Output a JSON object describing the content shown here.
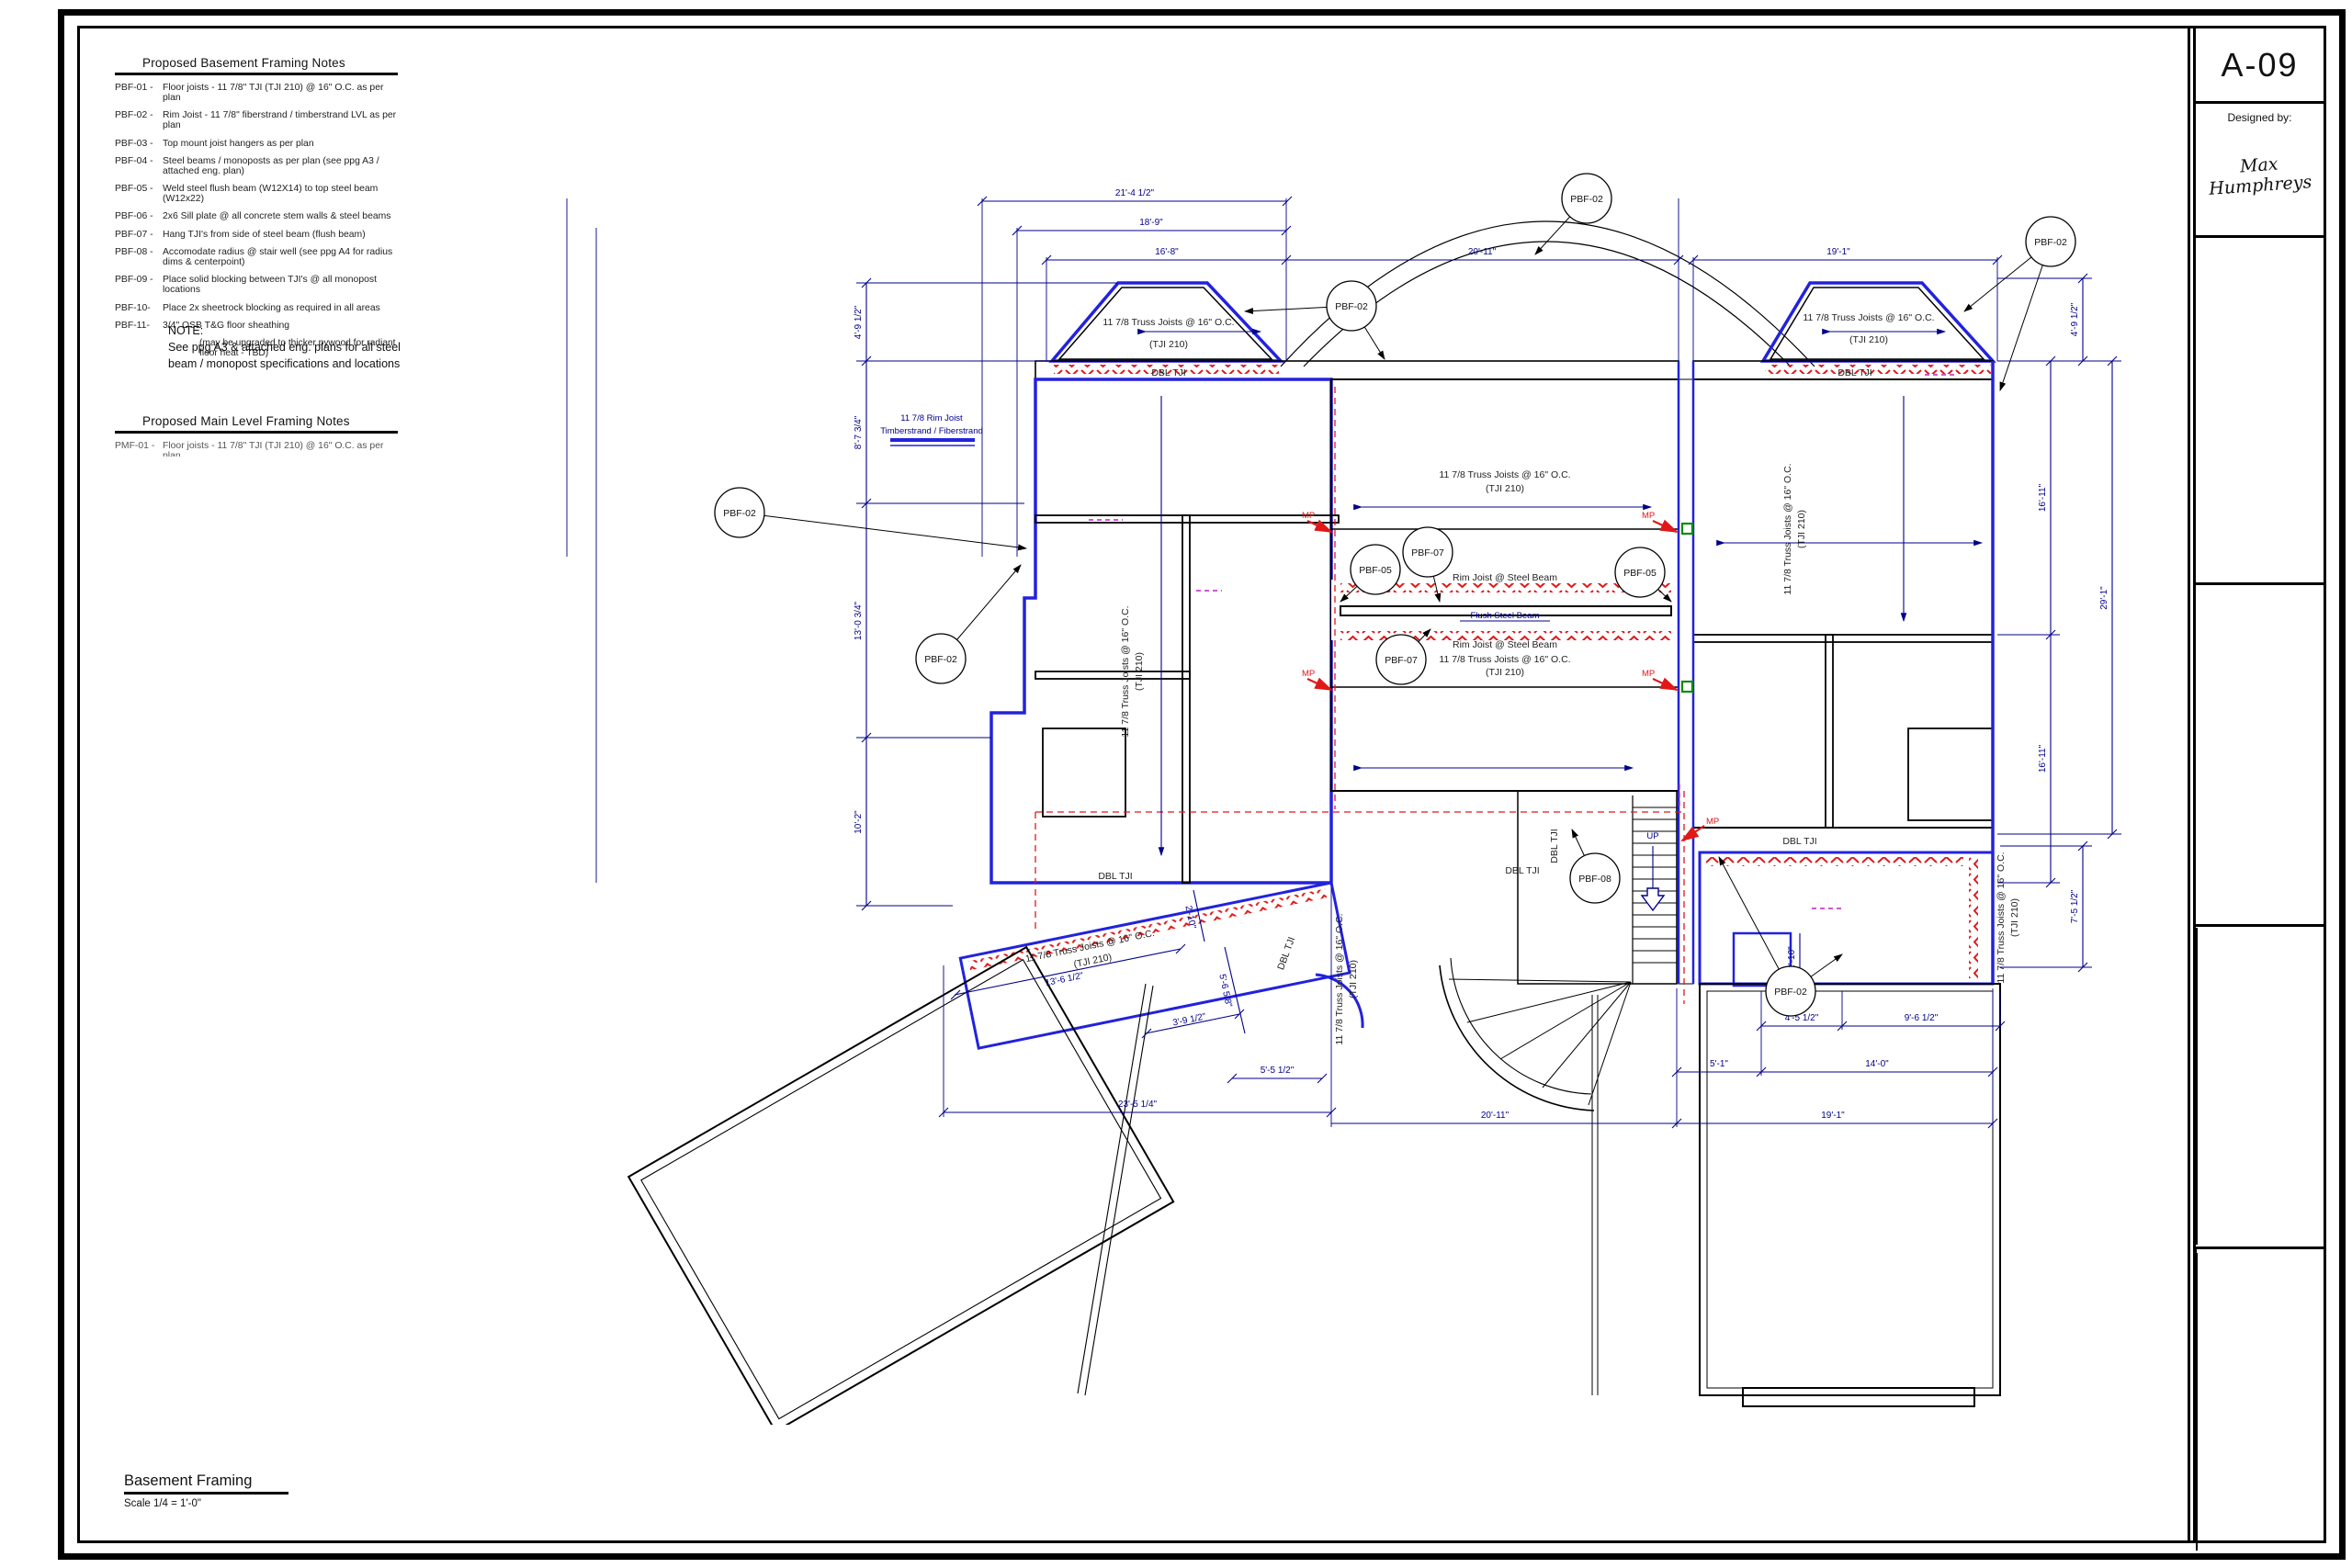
{
  "sheet": {
    "number": "A-09",
    "designed_by_label": "Designed by:",
    "designer": "Max Humphreys"
  },
  "client": {
    "line1": "Custom Architectural Drawing For",
    "name": "Ray & Shirley Quintana",
    "addr1": "2170 S. Wolcott Ct.",
    "addr2": "Denver, CO 80219"
  },
  "company": {
    "name1": "Basement",
    "name2": "DesignWorks",
    "name3": "by C&D, Inc.",
    "addr1": "14 Inverness Drive East",
    "addr2": "Suite G-136",
    "addr3": "Englewood, CO 80112",
    "addr4": "Phone: 303-799-0728",
    "addr5": "Fax: 303-799-0670",
    "addr6": "E-mail: www.cd-mgmt.com"
  },
  "rev_headers": {
    "date": "Date:",
    "revision": "Revision:",
    "description": "Description:"
  },
  "revisions_upper": [
    {
      "m": "7",
      "r": "Draft 7",
      "d": "08/27/05"
    },
    {
      "m": "8",
      "r": "Draft 8",
      "d": "08/30/05"
    },
    {
      "m": "9",
      "r": "Draft 9",
      "d": "09/05/05"
    },
    {
      "m": "F",
      "r": "Final Drawings",
      "d": "09/30/05"
    }
  ],
  "revisions_lower": [
    {
      "m": "1",
      "r": "Draft 1",
      "d": "05/02/05"
    },
    {
      "m": "2",
      "r": "Draft 2",
      "d": "06/02/05"
    },
    {
      "m": "3",
      "r": "Draft 3",
      "d": "06/18/05"
    },
    {
      "m": "4",
      "r": "Draft 4",
      "d": "07/18/05"
    },
    {
      "m": "5",
      "r": "Draft 5",
      "d": "07/21/05"
    },
    {
      "m": "6",
      "r": "Draft 6",
      "d": "08/10/05"
    }
  ],
  "notes": {
    "title": "Proposed Basement Framing Notes",
    "items": [
      {
        "code": "PBF-01 -",
        "text": "Floor joists - 11 7/8\" TJI (TJI 210) @ 16\" O.C. as per plan"
      },
      {
        "code": "PBF-02 -",
        "text": "Rim Joist - 11 7/8\" fiberstrand / timberstrand LVL as per plan"
      },
      {
        "code": "PBF-03 -",
        "text": "Top mount joist hangers as per plan"
      },
      {
        "code": "PBF-04 -",
        "text": "Steel beams / monoposts as per plan (see ppg A3 / attached eng. plan)"
      },
      {
        "code": "PBF-05 -",
        "text": "Weld steel flush beam (W12X14) to top steel beam (W12x22)"
      },
      {
        "code": "PBF-06 -",
        "text": "2x6 Sill plate @ all concrete stem walls & steel beams"
      },
      {
        "code": "PBF-07 -",
        "text": "Hang TJI's from side of steel beam (flush beam)"
      },
      {
        "code": "PBF-08 -",
        "text": "Accomodate radius @ stair well (see ppg A4 for radius dims & centerpoint)"
      },
      {
        "code": "PBF-09 -",
        "text": "Place solid blocking between TJI's @ all monopost locations"
      },
      {
        "code": "PBF-10-",
        "text": "Place 2x sheetrock blocking as required in all areas"
      },
      {
        "code": "PBF-11-",
        "text": "3/4\" OSB T&G floor sheathing"
      }
    ],
    "sub": "(may be upgraded to thicker pywood for radiant floor heat - TBD)"
  },
  "note_block": {
    "title": "NOTE:",
    "line1": "See ppg A3 & attached eng. plans for all steel",
    "line2": "beam / monopost specifications and locations"
  },
  "main_notes": {
    "title": "Proposed Main Level Framing Notes",
    "first_code": "PMF-01 -",
    "first_text": "Floor joists - 11 7/8\" TJI (TJI 210) @ 16\" O.C. as per plan"
  },
  "footer": {
    "title": "Basement Framing",
    "scale": "Scale 1/4 = 1'-0\""
  },
  "plan": {
    "labels": {
      "truss1": "11 7/8 Truss Joists @ 16\" O.C.",
      "truss2": "(TJI 210)",
      "dbl": "DBL TJI",
      "rim_beam": "Rim Joist @ Steel Beam",
      "flush": "Flush Steel Beam",
      "legend1": "11 7/8 Rim Joist",
      "legend2": "Timberstrand / Fiberstrand",
      "up": "UP",
      "mp": "MP"
    },
    "callouts": {
      "c02": "PBF-02",
      "c05": "PBF-05",
      "c07": "PBF-07",
      "c08": "PBF-08"
    },
    "dims": {
      "t1": "21'-4 1/2\"",
      "t2": "18'-9\"",
      "t3": "16'-8\"",
      "t4": "20'-11\"",
      "t5": "19'-1\"",
      "r1": "4'-9 1/2\"",
      "r2": "16'-11\"",
      "r3": "16'-11\"",
      "r4": "29'-1\"",
      "r5": "7'-5 1/2\"",
      "l1": "4'-9 1/2\"",
      "l2": "8'-7 3/4\"",
      "l3": "13'-0 3/4\"",
      "l4": "10'-2\"",
      "b1": "23'-5 1/4\"",
      "b2": "20'-11\"",
      "b3": "19'-1\"",
      "b4": "14'-0\"",
      "b5": "5'-1\"",
      "b6": "4'-5 1/2\"",
      "b7": "9'-6 1/2\"",
      "b8": "5'-5 1/2\"",
      "a1": "2'-10\"",
      "a2": "13'-6 1/2\"",
      "a3": "3'-9 1/2\"",
      "a4": "2'-10\"",
      "a5": "5'-6 5/8\""
    }
  },
  "colors": {
    "wall": "#2222dd",
    "dim": "#00008b",
    "red": "#e01818",
    "magenta": "#bb22bb",
    "green": "#0a8a0a"
  }
}
